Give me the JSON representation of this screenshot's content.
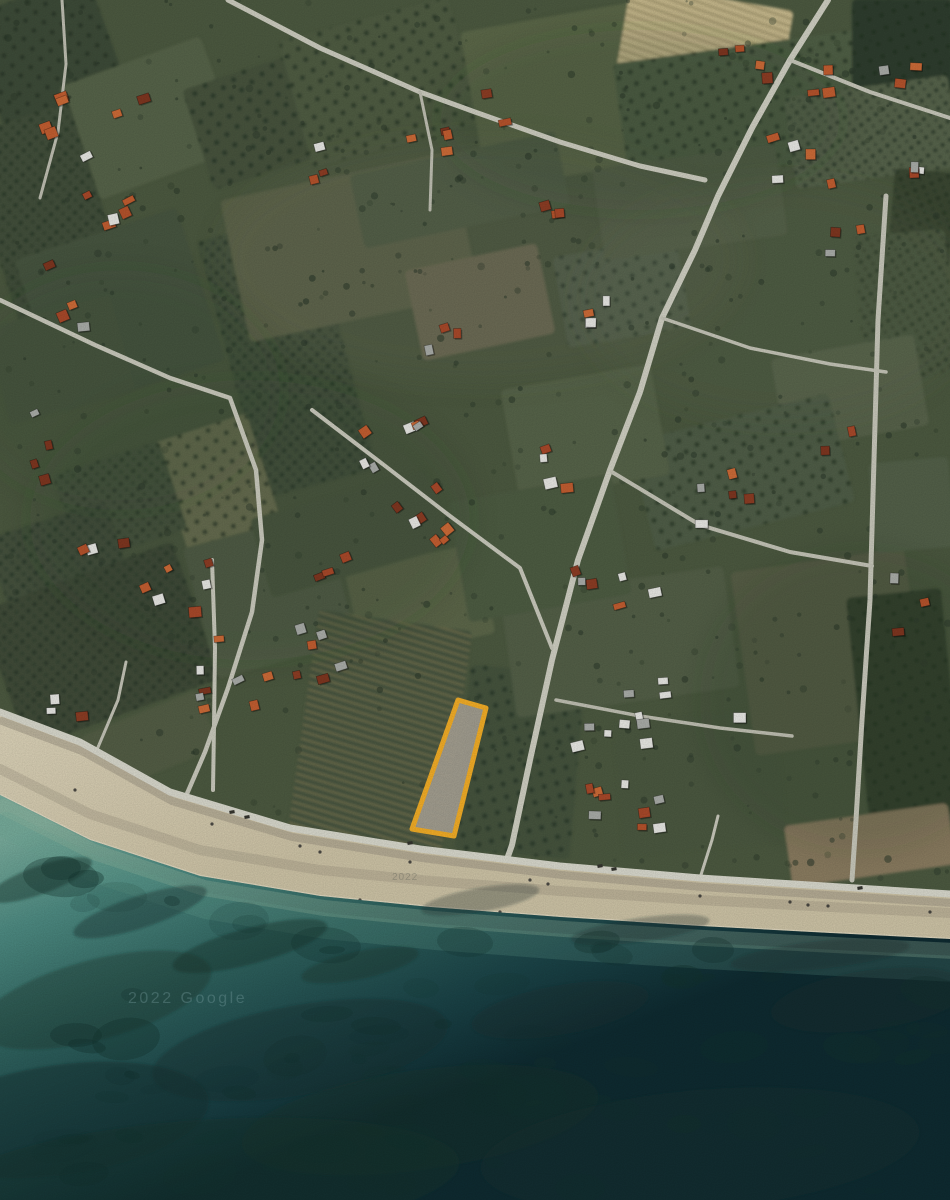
{
  "meta": {
    "kind": "satellite-map-screenshot",
    "width": 950,
    "height": 1200
  },
  "watermarks": [
    {
      "text": "2022 Google",
      "x": 128,
      "y": 1003,
      "size": 16,
      "spacing": 2.5,
      "color": "rgba(150,190,192,0.30)"
    },
    {
      "text": "2022",
      "x": 392,
      "y": 880,
      "size": 10,
      "spacing": 1,
      "color": "rgba(80,85,80,0.30)"
    }
  ],
  "parcel": {
    "points": [
      [
        458,
        700
      ],
      [
        486,
        708
      ],
      [
        454,
        836
      ],
      [
        412,
        829
      ]
    ],
    "stroke": "#F2AD27",
    "stroke_width": 5,
    "fill": "#A8A396",
    "fill_opacity": 0.93
  },
  "palette": {
    "land_base": "#4C5940",
    "tree": "#2C392B",
    "beach_top": "#DBD2B8",
    "beach_low": "#CDC3A6",
    "beach_debris": "#9B9381",
    "foam": "#EFE8D4",
    "sea_stops": [
      "#79AC9C",
      "#4E8B82",
      "#2F625E",
      "#1B4347",
      "#0F2B31"
    ],
    "reef": "#14332F",
    "shallow1": "#A3BCA2",
    "shallow2": "#6FA894",
    "house_orange": [
      "#B5532C",
      "#C25E31",
      "#A8492A",
      "#CC6B38"
    ],
    "house_dark": [
      "#8C3D24",
      "#7E3620"
    ],
    "house_white": "#E7E7E3",
    "house_gray": "#A9ACA8",
    "pattern_dot": "#263426",
    "pattern_stripe": "#2C3A2C",
    "vine_stripe": "#8A7F58"
  },
  "coast": {
    "road": [
      [
        0,
        712
      ],
      [
        80,
        742
      ],
      [
        170,
        792
      ],
      [
        290,
        828
      ],
      [
        420,
        849
      ],
      [
        560,
        866
      ],
      [
        700,
        878
      ],
      [
        950,
        894
      ]
    ],
    "waterline": [
      [
        0,
        795
      ],
      [
        90,
        840
      ],
      [
        200,
        876
      ],
      [
        320,
        896
      ],
      [
        430,
        907
      ],
      [
        560,
        917
      ],
      [
        700,
        926
      ],
      [
        830,
        933
      ],
      [
        950,
        939
      ]
    ]
  },
  "fields_format": "[cx,cy,w,h,rot,fill,texture]",
  "fields": [
    [
      45,
      50,
      130,
      115,
      -20,
      "#3E4B37",
      "dots"
    ],
    [
      150,
      118,
      150,
      120,
      -20,
      "#566349",
      null
    ],
    [
      260,
      120,
      130,
      105,
      -18,
      "#46533D",
      "dots"
    ],
    [
      45,
      215,
      115,
      200,
      -18,
      "#42503A",
      "rows"
    ],
    [
      120,
      310,
      170,
      160,
      -18,
      "#475440",
      null
    ],
    [
      60,
      360,
      130,
      100,
      -15,
      "#4A573F",
      null
    ],
    [
      287,
      355,
      115,
      265,
      -15,
      "#44523C",
      "rows"
    ],
    [
      380,
      82,
      175,
      130,
      -15,
      "#4F5C43",
      "dots"
    ],
    [
      560,
      96,
      175,
      160,
      -10,
      "#5B6749",
      null
    ],
    [
      705,
      40,
      165,
      88,
      10,
      "#C8BA8E",
      "vine"
    ],
    [
      748,
      108,
      255,
      125,
      -8,
      "#505E45",
      "dots"
    ],
    [
      902,
      45,
      100,
      92,
      0,
      "#2F3C2D",
      "dots"
    ],
    [
      872,
      132,
      165,
      92,
      -8,
      "#57644B",
      "rows"
    ],
    [
      922,
      218,
      62,
      95,
      5,
      "#3A4733",
      "rows"
    ],
    [
      350,
      247,
      235,
      145,
      -12,
      "#5C6349",
      null
    ],
    [
      480,
      302,
      135,
      92,
      -12,
      "#6C6B53",
      null
    ],
    [
      622,
      292,
      125,
      92,
      -10,
      "#52614B",
      "dots"
    ],
    [
      690,
      202,
      185,
      92,
      -8,
      "#535F46",
      null
    ],
    [
      905,
      305,
      92,
      145,
      -5,
      "#4C5940",
      "rows"
    ],
    [
      850,
      392,
      145,
      92,
      -10,
      "#58634B",
      null
    ],
    [
      742,
      472,
      205,
      112,
      -14,
      "#4F5D46",
      "dots"
    ],
    [
      585,
      432,
      152,
      112,
      -10,
      "#576348",
      null
    ],
    [
      222,
      497,
      98,
      145,
      -18,
      "#6D7252",
      "dots"
    ],
    [
      120,
      502,
      112,
      92,
      -18,
      "#49563F",
      "rows"
    ],
    [
      60,
      565,
      125,
      95,
      -18,
      "#44513C",
      "rows"
    ],
    [
      100,
      645,
      205,
      145,
      -20,
      "#3F4C39",
      "rows"
    ],
    [
      270,
      595,
      145,
      135,
      -15,
      "#535F46",
      null
    ],
    [
      420,
      602,
      135,
      92,
      -12,
      "#5B6649",
      null
    ],
    [
      350,
      533,
      185,
      82,
      -16,
      "#4C593F",
      null
    ],
    [
      380,
      732,
      155,
      225,
      8,
      "#47553F",
      "vine"
    ],
    [
      520,
      762,
      115,
      185,
      5,
      "#45533E",
      "dots"
    ],
    [
      620,
      642,
      225,
      122,
      -8,
      "#525F47",
      null
    ],
    [
      700,
      782,
      165,
      135,
      -5,
      "#4B583F",
      null
    ],
    [
      540,
      548,
      165,
      122,
      -10,
      "#4E5B43",
      null
    ],
    [
      830,
      652,
      175,
      185,
      -8,
      "#585F47",
      null
    ],
    [
      905,
      705,
      95,
      225,
      -6,
      "#36432F",
      "dots"
    ],
    [
      870,
      845,
      165,
      62,
      -8,
      "#8A7C60",
      null
    ],
    [
      150,
      742,
      125,
      62,
      -22,
      "#525D45",
      null
    ],
    [
      912,
      505,
      80,
      90,
      -5,
      "#52604A",
      null
    ],
    [
      460,
      190,
      210,
      75,
      -12,
      "#505D44",
      null
    ]
  ],
  "shading": [
    [
      480,
      260,
      260,
      120,
      "#6B7554",
      0.15
    ],
    [
      780,
      300,
      200,
      120,
      "#66704F",
      0.12
    ],
    [
      250,
      520,
      220,
      140,
      "#39462F",
      0.14
    ],
    [
      640,
      120,
      200,
      90,
      "#34402E",
      0.15
    ],
    [
      120,
      390,
      160,
      120,
      "#35422E",
      0.12
    ],
    [
      860,
      700,
      160,
      150,
      "#333F2C",
      0.15
    ]
  ],
  "roads": [
    {
      "coastal": true,
      "p": [
        [
          0,
          712
        ],
        [
          80,
          742
        ],
        [
          170,
          792
        ],
        [
          290,
          828
        ],
        [
          420,
          849
        ],
        [
          560,
          866
        ],
        [
          700,
          878
        ],
        [
          950,
          894
        ]
      ],
      "w": 7,
      "c": "#D8D8CC"
    },
    {
      "p": [
        [
          828,
          0
        ],
        [
          790,
          60
        ],
        [
          752,
          128
        ],
        [
          718,
          196
        ],
        [
          695,
          250
        ],
        [
          662,
          318
        ],
        [
          640,
          392
        ],
        [
          610,
          470
        ],
        [
          578,
          560
        ],
        [
          552,
          660
        ],
        [
          530,
          760
        ],
        [
          512,
          845
        ],
        [
          506,
          862
        ]
      ],
      "w": 6,
      "c": "#CFCFC2"
    },
    {
      "p": [
        [
          886,
          196
        ],
        [
          878,
          320
        ],
        [
          874,
          460
        ],
        [
          870,
          600
        ],
        [
          862,
          720
        ],
        [
          856,
          820
        ],
        [
          852,
          880
        ]
      ],
      "w": 5,
      "c": "#C7C7BA"
    },
    {
      "p": [
        [
          228,
          0
        ],
        [
          320,
          48
        ],
        [
          420,
          92
        ],
        [
          475,
          112
        ],
        [
          560,
          142
        ],
        [
          640,
          166
        ],
        [
          705,
          180
        ]
      ],
      "w": 5,
      "c": "#CCCCBF"
    },
    {
      "p": [
        [
          790,
          60
        ],
        [
          870,
          92
        ],
        [
          950,
          118
        ]
      ],
      "w": 4,
      "c": "#C7C7BA"
    },
    {
      "p": [
        [
          0,
          300
        ],
        [
          95,
          345
        ],
        [
          170,
          378
        ],
        [
          230,
          398
        ],
        [
          256,
          470
        ],
        [
          262,
          540
        ],
        [
          252,
          612
        ],
        [
          228,
          688
        ],
        [
          205,
          752
        ],
        [
          186,
          796
        ]
      ],
      "w": 4.5,
      "c": "#C9C9BC"
    },
    {
      "p": [
        [
          312,
          410
        ],
        [
          380,
          462
        ],
        [
          450,
          516
        ],
        [
          520,
          568
        ],
        [
          552,
          648
        ]
      ],
      "w": 4,
      "c": "#C9C9BC"
    },
    {
      "p": [
        [
          212,
          560
        ],
        [
          215,
          648
        ],
        [
          214,
          726
        ],
        [
          213,
          790
        ]
      ],
      "w": 4,
      "c": "#C9C9BC"
    },
    {
      "p": [
        [
          612,
          472
        ],
        [
          700,
          525
        ],
        [
          790,
          552
        ],
        [
          872,
          566
        ]
      ],
      "w": 4,
      "c": "#C4C4B7"
    },
    {
      "p": [
        [
          662,
          318
        ],
        [
          750,
          348
        ],
        [
          830,
          364
        ],
        [
          886,
          372
        ]
      ],
      "w": 3.5,
      "c": "#C4C4B7"
    },
    {
      "p": [
        [
          556,
          700
        ],
        [
          640,
          716
        ],
        [
          720,
          728
        ],
        [
          792,
          736
        ]
      ],
      "w": 3.5,
      "c": "#BFBFB2"
    },
    {
      "p": [
        [
          96,
          752
        ],
        [
          118,
          700
        ],
        [
          126,
          662
        ]
      ],
      "w": 3,
      "c": "#C4C4B7"
    },
    {
      "p": [
        [
          700,
          878
        ],
        [
          712,
          840
        ],
        [
          718,
          816
        ]
      ],
      "w": 3,
      "c": "#C9C9BC"
    },
    {
      "p": [
        [
          62,
          0
        ],
        [
          66,
          64
        ],
        [
          58,
          132
        ],
        [
          40,
          198
        ]
      ],
      "w": 3,
      "c": "#BFBFB2"
    },
    {
      "p": [
        [
          420,
          92
        ],
        [
          432,
          150
        ],
        [
          430,
          210
        ]
      ],
      "w": 3,
      "c": "#BFBFB2"
    }
  ],
  "houses": {
    "seed": 7,
    "cluster_format": "[cx,cy,count,spreadX,spreadY,rot,whiteBias]",
    "clusters": [
      [
        115,
        150,
        7,
        55,
        60,
        -20,
        0
      ],
      [
        60,
        290,
        4,
        30,
        40,
        -15,
        0
      ],
      [
        32,
        432,
        4,
        25,
        50,
        -15,
        0
      ],
      [
        105,
        525,
        3,
        30,
        25,
        -18,
        0
      ],
      [
        170,
        585,
        5,
        40,
        25,
        -18,
        0
      ],
      [
        318,
        640,
        5,
        35,
        40,
        -15,
        0
      ],
      [
        390,
        490,
        9,
        70,
        55,
        -35,
        0
      ],
      [
        268,
        700,
        4,
        30,
        30,
        -18,
        0
      ],
      [
        212,
        668,
        6,
        18,
        60,
        -5,
        0
      ],
      [
        70,
        708,
        3,
        22,
        20,
        -10,
        1
      ],
      [
        455,
        120,
        6,
        50,
        35,
        -12,
        0
      ],
      [
        312,
        162,
        3,
        28,
        20,
        -18,
        0
      ],
      [
        402,
        418,
        5,
        40,
        28,
        -30,
        0
      ],
      [
        612,
        592,
        6,
        45,
        30,
        -10,
        0
      ],
      [
        548,
        470,
        4,
        30,
        30,
        -10,
        0
      ],
      [
        778,
        115,
        9,
        60,
        70,
        -8,
        0
      ],
      [
        898,
        88,
        3,
        25,
        25,
        0,
        0
      ],
      [
        852,
        248,
        3,
        25,
        20,
        -5,
        0
      ],
      [
        735,
        505,
        5,
        40,
        35,
        -8,
        0
      ],
      [
        912,
        605,
        3,
        22,
        30,
        -5,
        0
      ],
      [
        655,
        733,
        8,
        85,
        18,
        -4,
        1
      ],
      [
        648,
        812,
        9,
        75,
        28,
        -6,
        0
      ],
      [
        600,
        308,
        4,
        25,
        28,
        -8,
        0
      ],
      [
        536,
        212,
        3,
        25,
        20,
        -10,
        0
      ],
      [
        447,
        340,
        3,
        25,
        20,
        -10,
        0
      ],
      [
        762,
        62,
        3,
        30,
        18,
        5,
        0
      ],
      [
        905,
        162,
        3,
        20,
        18,
        -5,
        0
      ],
      [
        120,
        218,
        3,
        25,
        18,
        -18,
        0
      ],
      [
        40,
        130,
        2,
        15,
        25,
        -20,
        0
      ],
      [
        340,
        575,
        3,
        25,
        18,
        -15,
        0
      ],
      [
        640,
        680,
        3,
        30,
        15,
        -5,
        0
      ],
      [
        840,
        440,
        2,
        20,
        15,
        -8,
        0
      ]
    ]
  },
  "trees": {
    "seed": 3,
    "count": 560
  },
  "seaweed": {
    "seed": 11,
    "count": 90
  },
  "reefs": [
    [
      40,
      880,
      55,
      14,
      -20,
      0.45
    ],
    [
      140,
      912,
      70,
      16,
      -18,
      0.4
    ],
    [
      250,
      946,
      80,
      18,
      -15,
      0.45
    ],
    [
      360,
      965,
      60,
      14,
      -12,
      0.35
    ],
    [
      95,
      1000,
      120,
      40,
      -15,
      0.35
    ],
    [
      300,
      1050,
      150,
      45,
      -10,
      0.4
    ],
    [
      60,
      1120,
      150,
      55,
      -8,
      0.5
    ],
    [
      420,
      1120,
      180,
      50,
      -8,
      0.35
    ],
    [
      700,
      1150,
      220,
      60,
      -5,
      0.4
    ],
    [
      870,
      1000,
      100,
      30,
      -8,
      0.3
    ],
    [
      560,
      1010,
      90,
      25,
      -10,
      0.3
    ],
    [
      480,
      900,
      60,
      12,
      -10,
      0.3
    ],
    [
      640,
      930,
      70,
      12,
      -8,
      0.3
    ],
    [
      820,
      955,
      90,
      14,
      -6,
      0.3
    ],
    [
      200,
      1180,
      260,
      60,
      -4,
      0.45
    ]
  ],
  "vehicles": [
    [
      232,
      812
    ],
    [
      247,
      817
    ],
    [
      410,
      843
    ],
    [
      600,
      866
    ],
    [
      614,
      869
    ],
    [
      860,
      888
    ]
  ],
  "beach_dots": [
    [
      212,
      824
    ],
    [
      300,
      846
    ],
    [
      320,
      852
    ],
    [
      410,
      862
    ],
    [
      530,
      880
    ],
    [
      548,
      884
    ],
    [
      700,
      896
    ],
    [
      790,
      902
    ],
    [
      808,
      905
    ],
    [
      828,
      906
    ],
    [
      930,
      912
    ],
    [
      360,
      900
    ],
    [
      500,
      912
    ],
    [
      640,
      925
    ],
    [
      75,
      790
    ]
  ]
}
